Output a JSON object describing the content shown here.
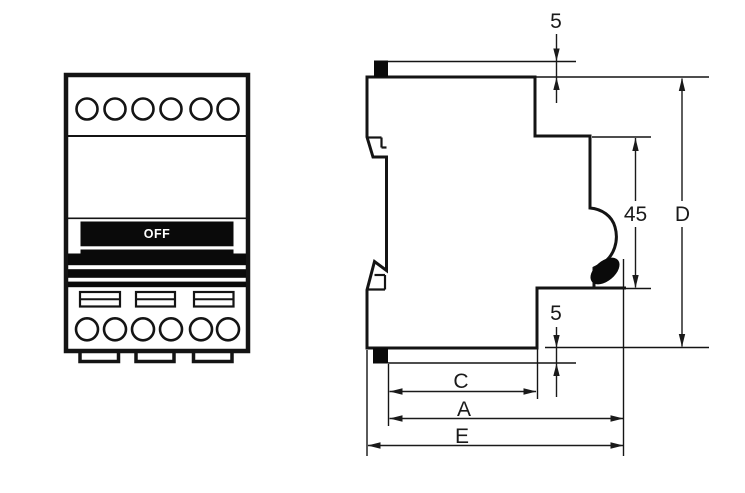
{
  "drawing": {
    "front_view": {
      "toggle_label": "OFF"
    },
    "dimensions": {
      "top_rail_offset": "5",
      "bottom_rail_offset": "5",
      "handle_recess_depth": "45",
      "total_depth": "D",
      "width_c": "C",
      "width_a": "A",
      "width_e": "E"
    },
    "colors": {
      "line": "#1a1a1a",
      "solid_fill": "#0a0a0a",
      "background": "#ffffff"
    }
  }
}
